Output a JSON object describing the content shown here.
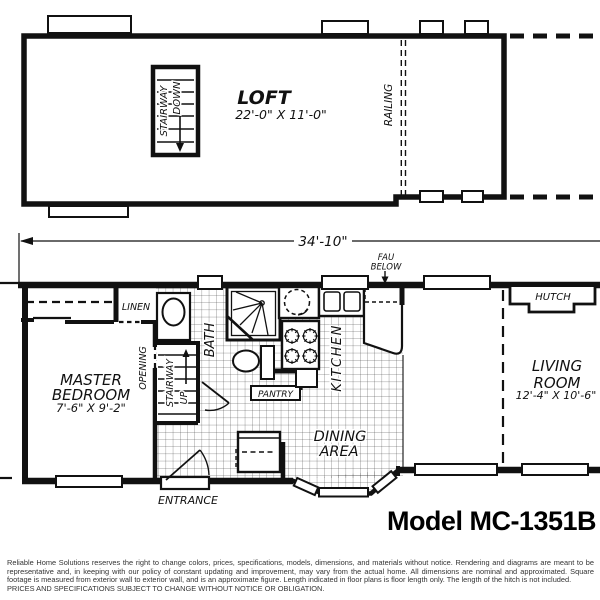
{
  "loft_plan": {
    "room_label": "LOFT",
    "room_dims": "22'-0\" X 11'-0\"",
    "stairway_line1": "STAIRWAY",
    "stairway_line2": "DOWN",
    "railing_label": "RAILING"
  },
  "dimension": {
    "overall_length": "34'-10\""
  },
  "main_plan": {
    "fau_line1": "FAU",
    "fau_line2": "BELOW",
    "linen_label": "LINEN",
    "hutch_label": "HUTCH",
    "opening_label": "OPENING",
    "stairway_line1": "STAIRWAY",
    "stairway_line2": "UP",
    "bath_label": "BATH",
    "pantry_label": "PANTRY",
    "kitchen_label": "KITCHEN",
    "entrance_label": "ENTRANCE",
    "master_bedroom": {
      "line1": "MASTER",
      "line2": "BEDROOM",
      "dims": "7'-6\" X 9'-2\""
    },
    "dining": {
      "line1": "DINING",
      "line2": "AREA"
    },
    "living": {
      "line1": "LIVING",
      "line2": "ROOM",
      "dims": "12'-4\" X 10'-6\""
    }
  },
  "title": "Model MC-1351B",
  "disclaimer": {
    "body": "Reliable Home Solutions reserves the right to change colors, prices, specifications, models, dimensions, and materials without notice. Rendering and diagrams are meant to be representative and, in keeping with our policy of constant updating and improvement, may vary from the actual home. All dimensions are nominal and approximated. Square footage is measured from exterior wall to exterior wall, and is an approximate figure. Length indicated in floor plans is floor length only. The length of the hitch is not included.",
    "caps": "PRICES AND SPECIFICATIONS SUBJECT TO CHANGE WITHOUT NOTICE OR OBLIGATION."
  },
  "colors": {
    "line": "#111111",
    "background": "#ffffff",
    "disclaimer_text": "#333333"
  }
}
